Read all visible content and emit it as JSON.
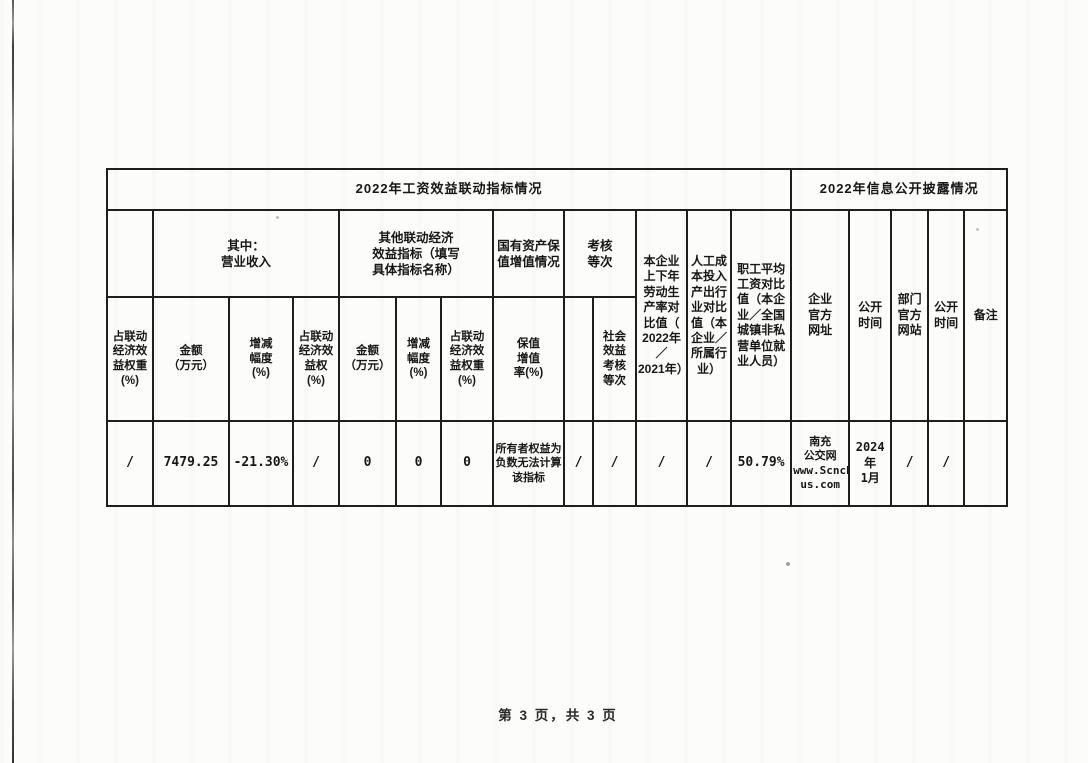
{
  "page": {
    "footer": "第 3 页，共 3 页"
  },
  "colors": {
    "ink": "#171717",
    "border": "#1e1e1e",
    "paper": "#fcfcfa"
  },
  "table": {
    "section_left_title": "2022年工资效益联动指标情况",
    "section_right_title": "2022年信息公开披露情况",
    "groups": [
      {
        "name": "blank",
        "label": ""
      },
      {
        "name": "operating-revenue",
        "label": "其中：\n营业收入"
      },
      {
        "name": "other-linked-indicators",
        "label": "其他联动经济\n效益指标（填写\n具体指标名称）"
      },
      {
        "name": "state-asset-preservation",
        "label": "国有资产保\n值增值情况"
      },
      {
        "name": "assessment-grade",
        "label": "考核\n等次"
      }
    ],
    "merged_cols": [
      {
        "name": "labor-productivity-ratio",
        "label": "本企业\n上下年\n劳动生\n产率对\n比值（\n2022年／\n2021年）"
      },
      {
        "name": "labor-cost-io-ratio",
        "label": "人工成\n本投入\n产出行\n业对比\n值（本\n企业／\n所属行\n业）"
      },
      {
        "name": "avg-wage-ratio",
        "label": "职工平均\n工资对比\n值（本企\n业／全国\n城镇非私\n营单位就\n业人员）"
      },
      {
        "name": "company-website",
        "label": "企业\n官方\n网址"
      },
      {
        "name": "publish-time-1",
        "label": "公开\n时间"
      },
      {
        "name": "dept-website",
        "label": "部门\n官方\n网站"
      },
      {
        "name": "publish-time-2",
        "label": "公开\n时间"
      },
      {
        "name": "remarks",
        "label": "备注"
      }
    ],
    "sub_headers": [
      {
        "label": "占联动\n经济效\n益权重\n(%)"
      },
      {
        "label": "金额\n（万元）"
      },
      {
        "label": "增减\n幅度\n(%)"
      },
      {
        "label": "占联动\n经济效\n益权\n(%)"
      },
      {
        "label": "金额\n（万元）"
      },
      {
        "label": "增减\n幅度\n(%)"
      },
      {
        "label": "占联动\n经济效\n益权重\n(%)"
      },
      {
        "label": "保值\n增值\n率(%)"
      },
      {
        "label": ""
      },
      {
        "label": "社会\n效益\n考核\n等次"
      }
    ],
    "data_row": [
      {
        "value": "/"
      },
      {
        "value": "7479.25"
      },
      {
        "value": "-21.30%"
      },
      {
        "value": "/"
      },
      {
        "value": "0"
      },
      {
        "value": "0"
      },
      {
        "value": "0"
      },
      {
        "value": "所有者权益为\n负数无法计算\n该指标"
      },
      {
        "value": "/"
      },
      {
        "value": "/"
      },
      {
        "value": "/"
      },
      {
        "value": "/"
      },
      {
        "value": "50.79%"
      },
      {
        "value": "南充\n公交网\nwww.Scncb\nus.com"
      },
      {
        "value": "2024年\n1月"
      },
      {
        "value": "/"
      },
      {
        "value": "/"
      },
      {
        "value": ""
      }
    ]
  }
}
